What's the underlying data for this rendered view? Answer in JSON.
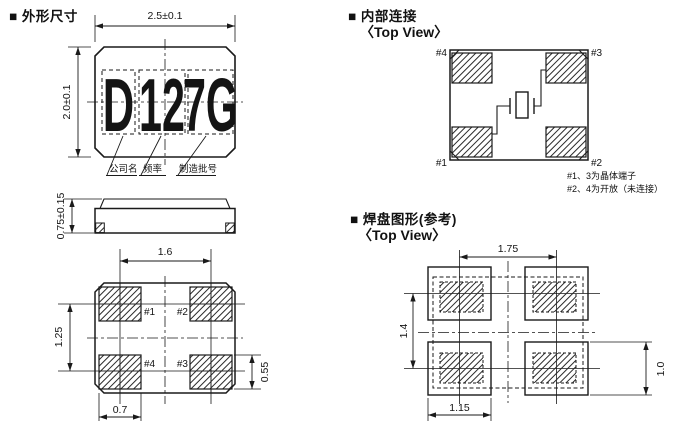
{
  "colors": {
    "ink": "#1a1a1a",
    "background": "#ffffff",
    "hatch": "#2a2a2a"
  },
  "outline_section": {
    "title": "■ 外形尺寸",
    "top_view": {
      "dim_width": "2.5±0.1",
      "dim_height": "2.0±0.1",
      "marking": {
        "company_code": "D",
        "frequency_code": "12",
        "lot_code": "7G"
      },
      "marking_labels": {
        "company": "公司名",
        "frequency": "频率",
        "lot": "制造批号"
      }
    },
    "side_view": {
      "dim_thickness": "0.75±0.15"
    },
    "bottom_view": {
      "dim_pad_pitch_x": "1.6",
      "dim_pad_pitch_y": "1.25",
      "dim_pad_width": "0.7",
      "dim_pad_height": "0.55",
      "pad_labels": {
        "top_left": "#1",
        "top_right": "#2",
        "bottom_left": "#4",
        "bottom_right": "#3"
      }
    }
  },
  "internal_section": {
    "title": "■ 内部连接",
    "view_label": "〈Top View〉",
    "pad_labels": {
      "top_left": "#4",
      "top_right": "#3",
      "bottom_left": "#1",
      "bottom_right": "#2"
    },
    "notes": {
      "line1": "#1、3为晶体端子",
      "line2": "#2、4为开放（未连接）"
    }
  },
  "land_section": {
    "title": "■ 焊盘图形(参考)",
    "view_label": "〈Top View〉",
    "dim_pitch_x": "1.75",
    "dim_pitch_y": "1.4",
    "dim_pad_width": "1.15",
    "dim_pad_height": "1.0"
  }
}
